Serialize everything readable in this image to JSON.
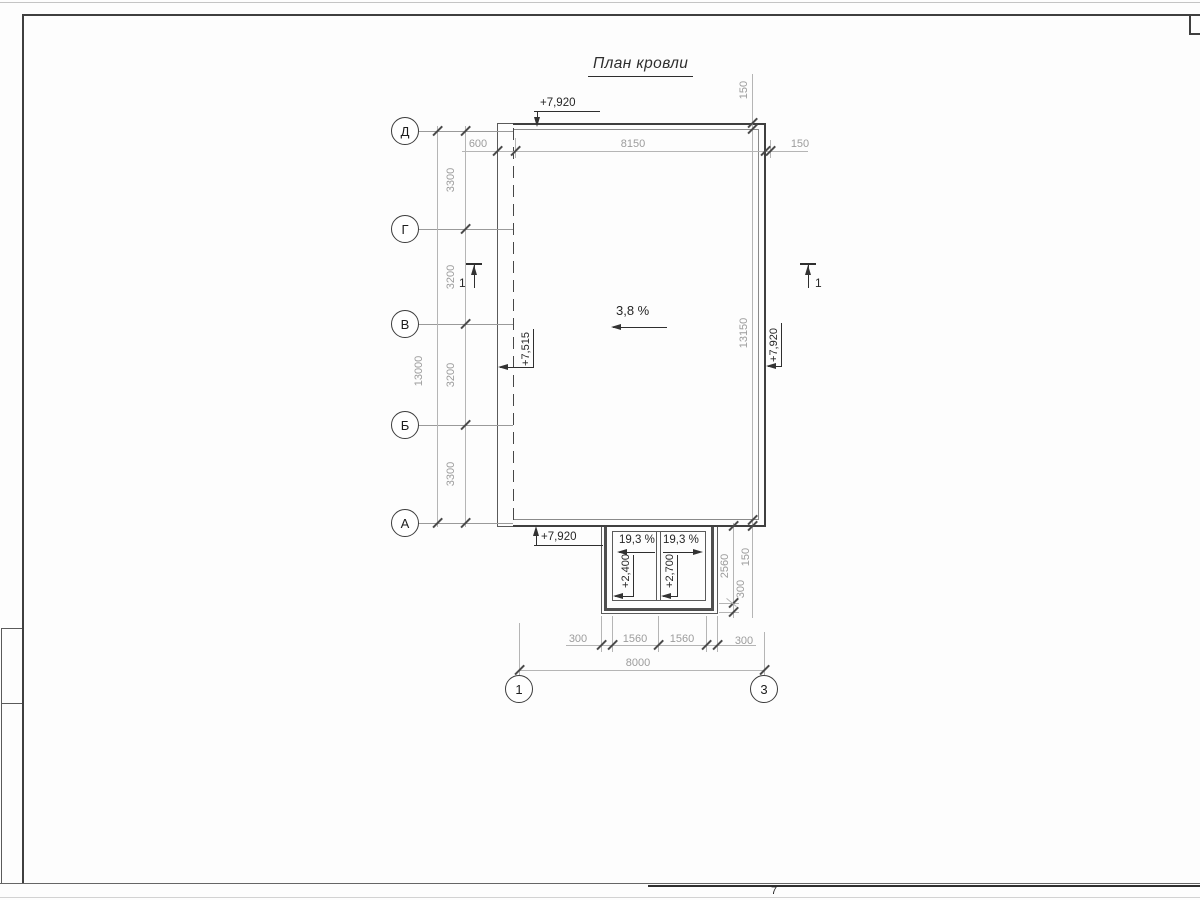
{
  "title": "План кровли",
  "grid_axes": {
    "rows": [
      "Д",
      "Г",
      "В",
      "Б",
      "А"
    ],
    "cols": [
      "1",
      "3"
    ]
  },
  "dims": {
    "left_overall": "13000",
    "left_segs": [
      "3300",
      "3200",
      "3200",
      "3300"
    ],
    "top_segs": [
      "600",
      "8150",
      "150"
    ],
    "right_top": "150",
    "right_overall": "13150",
    "right_mid": "150",
    "canopy_height": "2560",
    "canopy_parapet": "300",
    "bottom_segs": [
      "300",
      "1560",
      "1560",
      "300"
    ],
    "bottom_overall": "8000"
  },
  "levels": {
    "top": "+7,920",
    "left": "+7,515",
    "right": "+7,920",
    "bottom": "+7,920",
    "canopy_left": "+2,400",
    "canopy_right": "+2,700"
  },
  "slopes": {
    "main": "3,8 %",
    "canopy_left": "19,3 %",
    "canopy_right": "19,3 %"
  },
  "sections": {
    "left": "1",
    "right": "1"
  },
  "sheet": {
    "note": "7"
  },
  "colors": {
    "line_dark": "#3f3f3f",
    "line_dim": "#b5b5b5",
    "text_dim": "#9c9c9c",
    "text_dark": "#262626"
  }
}
